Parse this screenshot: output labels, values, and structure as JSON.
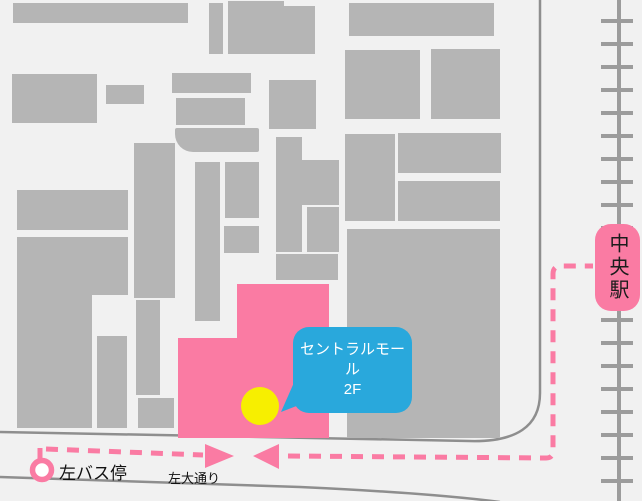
{
  "map": {
    "destination_bubble": {
      "line1": "セントラルモール",
      "line2": "2F"
    },
    "station": {
      "label": "中央駅"
    },
    "bus_stop": {
      "label": "左バス停"
    },
    "street": {
      "label": "左大通り"
    },
    "colors": {
      "highlight_pink": "#fa7ba3",
      "route_pink": "#fa7ba3",
      "bubble_blue": "#29a8dc",
      "marker_yellow": "#f7ef00",
      "building_gray": "#b5b5b5",
      "road_line_gray": "#8e8e8e",
      "railway_gray": "#9c9c9c",
      "background": "#f1f1f1"
    }
  }
}
